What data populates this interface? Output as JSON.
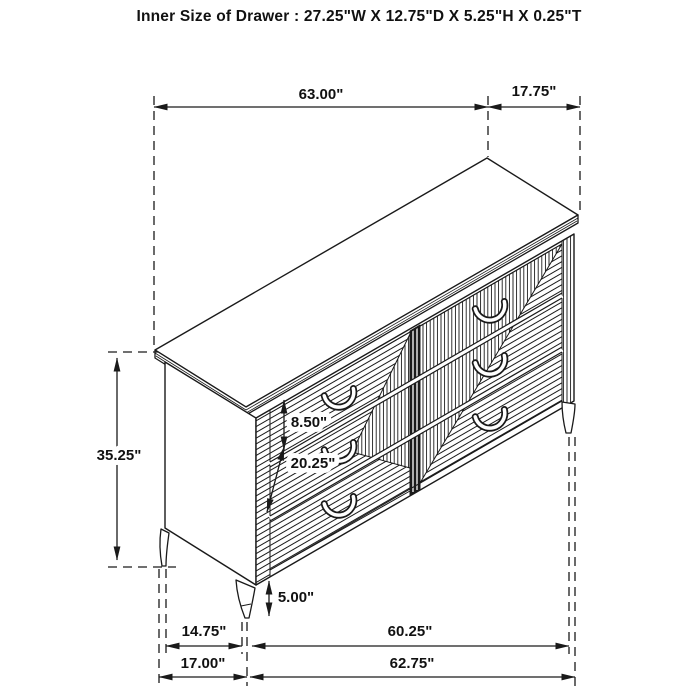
{
  "title": "Inner Size of Drawer : 27.25\"W X 12.75\"D X 5.25\"H X 0.25\"T",
  "dimensions": {
    "top_width": "63.00\"",
    "top_depth": "17.75\"",
    "overall_height": "35.25\"",
    "drawer_front_height": "8.50\"",
    "drawer_stack_height": "20.25\"",
    "leg_height": "5.00\"",
    "left_leg_span": "14.75\"",
    "leg_span_width": "60.25\"",
    "side_depth_bottom": "17.00\"",
    "bottom_width": "62.75\""
  },
  "colors": {
    "line": "#1a1a1a",
    "background": "#ffffff"
  }
}
